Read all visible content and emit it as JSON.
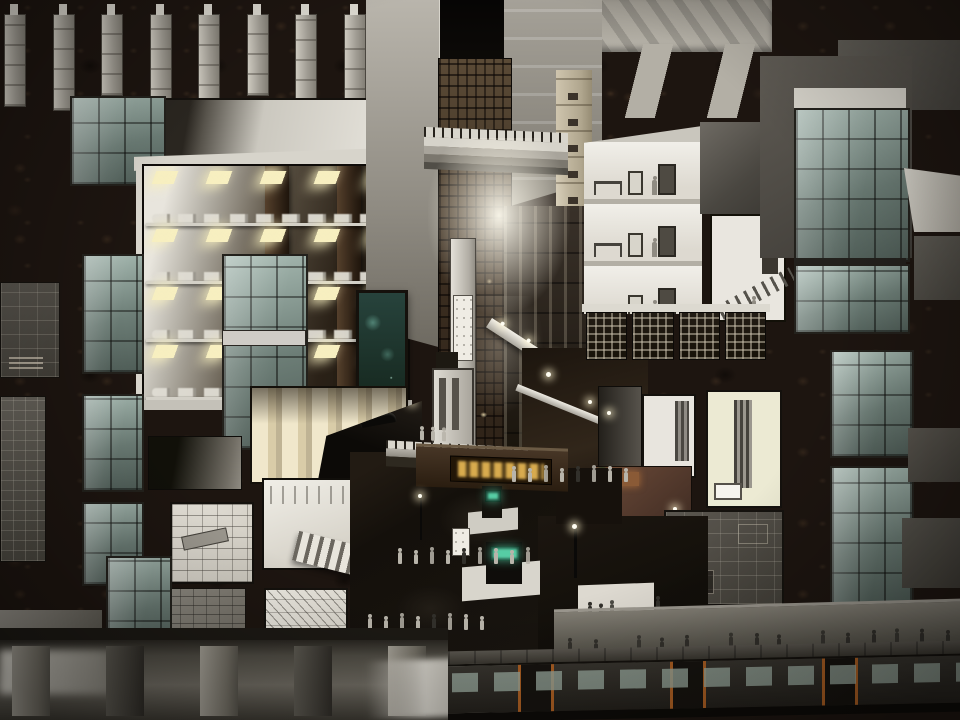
{
  "meta": {
    "title": "Architectural sectional perspective — underground urban transit complex at night",
    "description": "Cutaway rendering through dark earth: foundation piles above, a multi-level automated parking garage with lit shelves of cars, a tall central atrium with bridges and a glowing lightwell, sectioned offices and rooms, glass elevator shafts, a pedestrian plaza with metro entrances, signs and crowds, and a subway train at platform level."
  },
  "palette": {
    "earth": "#1d1510",
    "concrete": "#b7b3a9",
    "room_white": "#eceae3",
    "glass_hi": "#a9bcb4",
    "glass_lo": "#4e5c56",
    "light_warm": "#f7efc0",
    "glow": "#fffdf2",
    "sign_gold": "#d8ab4e",
    "sign_green": "#5fe0b4",
    "cream": "#ead9b2",
    "brick": "#5e4233",
    "plaza": "#14100c",
    "bronze": "#4a3a28",
    "person_light": "#b8b4aa",
    "person_dark": "#32302b",
    "train_accent": "#a85d22"
  },
  "counts": {
    "foundation_piles": 8,
    "garage_levels": 4,
    "office_floors": 3,
    "lattice_panels": 4,
    "balcony_lights": 6,
    "corridor_people": 4,
    "mezzanine_people": 3,
    "plaza_people_upper": 8,
    "plaza_people_mid": 9,
    "plaza_people_lower": 8,
    "plaza_people_right": 5,
    "walkway_people": 14,
    "station_panel_people": 3,
    "platform_pillars": 5,
    "basement_people": 2
  }
}
